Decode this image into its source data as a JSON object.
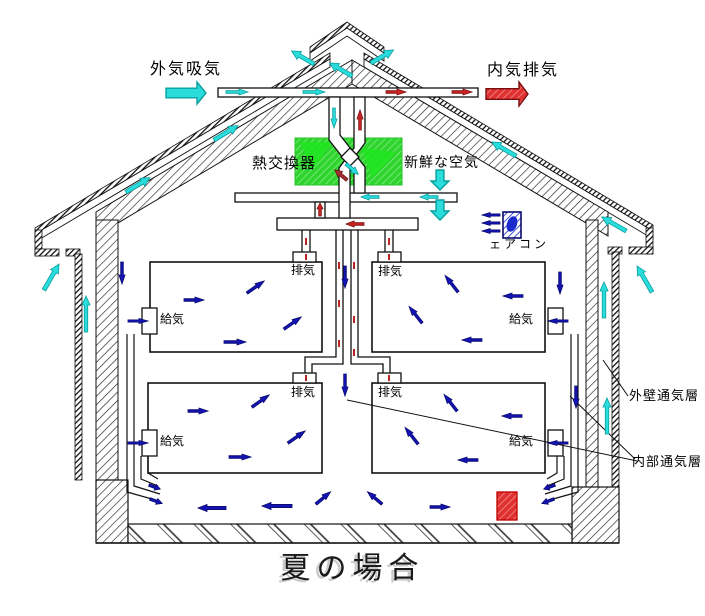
{
  "title": {
    "text": "夏の場合"
  },
  "labels": {
    "outside_air_intake": "外気吸気",
    "inside_air_exhaust": "内気排気",
    "heat_exchanger": "熱交換器",
    "fresh_air": "新鮮な空気",
    "air_conditioner": "ェアコン",
    "outer_wall_vent_layer": "外壁通気層",
    "inner_vent_layer": "内部通気層"
  },
  "rooms": [
    {
      "name": "upper-left",
      "exhaust": "排気",
      "supply": "給気"
    },
    {
      "name": "upper-right",
      "exhaust": "排気",
      "supply": "給気"
    },
    {
      "name": "lower-left",
      "exhaust": "排気",
      "supply": "給気"
    },
    {
      "name": "lower-right",
      "exhaust": "排気",
      "supply": "給気"
    }
  ],
  "colors": {
    "cyan": "#2adcdc",
    "cyan_dark": "#0a9f9f",
    "red": "#cc2222",
    "red_dark": "#7a0f0f",
    "blue": "#1414b4",
    "blue_dark": "#0a0a6e",
    "darkred": "#a03030",
    "darkred_dark": "#701818",
    "green": "#2fd42f",
    "duct_tick": "#bb2222"
  },
  "airflow_arrows": [
    {
      "x": 166,
      "y": 93,
      "r": 0,
      "l": 40,
      "w": 22,
      "c": "cyan",
      "o": true
    },
    {
      "x": 486,
      "y": 94,
      "r": 0,
      "l": 42,
      "w": 24,
      "c": "red",
      "o": true
    },
    {
      "x": 440,
      "y": 170,
      "r": 90,
      "l": 20,
      "w": 18,
      "c": "cyan",
      "o": true
    },
    {
      "x": 440,
      "y": 200,
      "r": 90,
      "l": 20,
      "w": 18,
      "c": "cyan",
      "o": true
    },
    {
      "x": 314,
      "y": 64,
      "r": -150,
      "l": 26,
      "w": 9,
      "c": "cyan",
      "o": false
    },
    {
      "x": 352,
      "y": 76,
      "r": -150,
      "l": 26,
      "w": 9,
      "c": "cyan",
      "o": false
    },
    {
      "x": 371,
      "y": 63,
      "r": -30,
      "l": 26,
      "w": 9,
      "c": "cyan",
      "o": false
    },
    {
      "x": 126,
      "y": 192,
      "r": -31,
      "l": 28,
      "w": 9,
      "c": "cyan",
      "o": false
    },
    {
      "x": 214,
      "y": 140,
      "r": -31,
      "l": 28,
      "w": 9,
      "c": "cyan",
      "o": false
    },
    {
      "x": 516,
      "y": 156,
      "r": -150,
      "l": 28,
      "w": 9,
      "c": "cyan",
      "o": false
    },
    {
      "x": 626,
      "y": 231,
      "r": -150,
      "l": 28,
      "w": 9,
      "c": "cyan",
      "o": false
    },
    {
      "x": 44,
      "y": 290,
      "r": -60,
      "l": 30,
      "w": 9,
      "c": "cyan",
      "o": false
    },
    {
      "x": 652,
      "y": 292,
      "r": -120,
      "l": 30,
      "w": 9,
      "c": "cyan",
      "o": false
    },
    {
      "x": 86,
      "y": 332,
      "r": -90,
      "l": 36,
      "w": 8,
      "c": "cyan",
      "o": false
    },
    {
      "x": 604,
      "y": 318,
      "r": -90,
      "l": 36,
      "w": 8,
      "c": "cyan",
      "o": false
    },
    {
      "x": 607,
      "y": 434,
      "r": -90,
      "l": 36,
      "w": 8,
      "c": "cyan",
      "o": false
    },
    {
      "x": 226,
      "y": 92,
      "r": 0,
      "l": 22,
      "w": 6,
      "c": "cyan",
      "o": false
    },
    {
      "x": 303,
      "y": 92,
      "r": 0,
      "l": 22,
      "w": 6,
      "c": "cyan",
      "o": false
    },
    {
      "x": 386,
      "y": 92,
      "r": 0,
      "l": 20,
      "w": 6,
      "c": "red",
      "o": false
    },
    {
      "x": 452,
      "y": 92,
      "r": 0,
      "l": 20,
      "w": 6,
      "c": "red",
      "o": false
    },
    {
      "x": 334,
      "y": 108,
      "r": 90,
      "l": 20,
      "w": 6,
      "c": "cyan",
      "o": false
    },
    {
      "x": 360,
      "y": 130,
      "r": -90,
      "l": 20,
      "w": 6,
      "c": "red",
      "o": false
    },
    {
      "x": 347,
      "y": 180,
      "r": -140,
      "l": 16,
      "w": 7,
      "c": "darkred",
      "o": false
    },
    {
      "x": 346,
      "y": 164,
      "r": 40,
      "l": 16,
      "w": 7,
      "c": "cyan",
      "o": false
    },
    {
      "x": 379,
      "y": 197,
      "r": 180,
      "l": 18,
      "w": 6,
      "c": "cyan",
      "o": false
    },
    {
      "x": 438,
      "y": 197,
      "r": 180,
      "l": 18,
      "w": 6,
      "c": "cyan",
      "o": false
    },
    {
      "x": 364,
      "y": 224,
      "r": 180,
      "l": 18,
      "w": 6,
      "c": "red",
      "o": false
    },
    {
      "x": 320,
      "y": 216,
      "r": -90,
      "l": 13,
      "w": 6,
      "c": "red",
      "o": false
    },
    {
      "x": 500,
      "y": 215,
      "r": 180,
      "l": 18,
      "w": 5,
      "c": "blue",
      "o": false
    },
    {
      "x": 500,
      "y": 223,
      "r": 180,
      "l": 18,
      "w": 5,
      "c": "blue",
      "o": false
    },
    {
      "x": 500,
      "y": 231,
      "r": 180,
      "l": 18,
      "w": 5,
      "c": "blue",
      "o": false
    },
    {
      "x": 184,
      "y": 300,
      "r": 0,
      "l": 20,
      "w": 6,
      "c": "blue",
      "o": false
    },
    {
      "x": 247,
      "y": 293,
      "r": -35,
      "l": 21,
      "w": 6,
      "c": "blue",
      "o": false
    },
    {
      "x": 284,
      "y": 329,
      "r": -35,
      "l": 21,
      "w": 6,
      "c": "blue",
      "o": false
    },
    {
      "x": 224,
      "y": 342,
      "r": 0,
      "l": 22,
      "w": 6,
      "c": "blue",
      "o": false
    },
    {
      "x": 458,
      "y": 292,
      "r": -128,
      "l": 21,
      "w": 6,
      "c": "blue",
      "o": false
    },
    {
      "x": 523,
      "y": 296,
      "r": 180,
      "l": 20,
      "w": 6,
      "c": "blue",
      "o": false
    },
    {
      "x": 422,
      "y": 323,
      "r": -128,
      "l": 21,
      "w": 6,
      "c": "blue",
      "o": false
    },
    {
      "x": 482,
      "y": 340,
      "r": 180,
      "l": 20,
      "w": 6,
      "c": "blue",
      "o": false
    },
    {
      "x": 188,
      "y": 411,
      "r": 0,
      "l": 20,
      "w": 6,
      "c": "blue",
      "o": false
    },
    {
      "x": 252,
      "y": 407,
      "r": -35,
      "l": 21,
      "w": 6,
      "c": "blue",
      "o": false
    },
    {
      "x": 288,
      "y": 443,
      "r": -35,
      "l": 21,
      "w": 6,
      "c": "blue",
      "o": false
    },
    {
      "x": 229,
      "y": 457,
      "r": 0,
      "l": 22,
      "w": 6,
      "c": "blue",
      "o": false
    },
    {
      "x": 457,
      "y": 411,
      "r": -128,
      "l": 21,
      "w": 6,
      "c": "blue",
      "o": false
    },
    {
      "x": 522,
      "y": 416,
      "r": 180,
      "l": 20,
      "w": 6,
      "c": "blue",
      "o": false
    },
    {
      "x": 418,
      "y": 444,
      "r": -128,
      "l": 21,
      "w": 6,
      "c": "blue",
      "o": false
    },
    {
      "x": 478,
      "y": 460,
      "r": 180,
      "l": 20,
      "w": 6,
      "c": "blue",
      "o": false
    },
    {
      "x": 345,
      "y": 266,
      "r": 90,
      "l": 22,
      "w": 6,
      "c": "blue",
      "o": false
    },
    {
      "x": 345,
      "y": 374,
      "r": 90,
      "l": 22,
      "w": 6,
      "c": "blue",
      "o": false
    },
    {
      "x": 122,
      "y": 262,
      "r": 90,
      "l": 22,
      "w": 6,
      "c": "blue",
      "o": false
    },
    {
      "x": 560,
      "y": 272,
      "r": 90,
      "l": 22,
      "w": 6,
      "c": "blue",
      "o": false
    },
    {
      "x": 576,
      "y": 386,
      "r": 90,
      "l": 22,
      "w": 6,
      "c": "blue",
      "o": false
    },
    {
      "x": 128,
      "y": 321,
      "r": 0,
      "l": 20,
      "w": 5,
      "c": "blue",
      "o": false
    },
    {
      "x": 128,
      "y": 443,
      "r": 0,
      "l": 20,
      "w": 5,
      "c": "blue",
      "o": false
    },
    {
      "x": 568,
      "y": 321,
      "r": 180,
      "l": 20,
      "w": 5,
      "c": "blue",
      "o": false
    },
    {
      "x": 568,
      "y": 443,
      "r": 180,
      "l": 20,
      "w": 5,
      "c": "blue",
      "o": false
    },
    {
      "x": 150,
      "y": 499,
      "r": 20,
      "l": 13,
      "w": 6,
      "c": "blue",
      "o": false
    },
    {
      "x": 149,
      "y": 485,
      "r": 20,
      "l": 12,
      "w": 6,
      "c": "blue",
      "o": false
    },
    {
      "x": 554,
      "y": 499,
      "r": 160,
      "l": 13,
      "w": 6,
      "c": "blue",
      "o": false
    },
    {
      "x": 555,
      "y": 485,
      "r": 160,
      "l": 12,
      "w": 6,
      "c": "blue",
      "o": false
    },
    {
      "x": 226,
      "y": 508,
      "r": 180,
      "l": 28,
      "w": 7,
      "c": "blue",
      "o": false
    },
    {
      "x": 292,
      "y": 506,
      "r": 180,
      "l": 30,
      "w": 7,
      "c": "blue",
      "o": false
    },
    {
      "x": 316,
      "y": 504,
      "r": -40,
      "l": 19,
      "w": 6,
      "c": "blue",
      "o": false
    },
    {
      "x": 382,
      "y": 504,
      "r": -140,
      "l": 19,
      "w": 6,
      "c": "blue",
      "o": false
    },
    {
      "x": 430,
      "y": 507,
      "r": 0,
      "l": 20,
      "w": 6,
      "c": "blue",
      "o": false
    }
  ]
}
